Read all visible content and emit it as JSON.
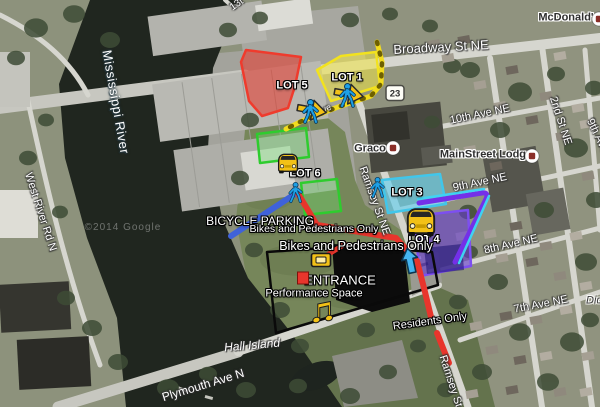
{
  "map": {
    "attribution": "©2014 Google",
    "highway_shield": {
      "label": "23",
      "x": 395,
      "y": 93
    },
    "labels": [
      {
        "id": "street-13t-partial",
        "text": "13t",
        "x": 237,
        "y": 5,
        "rot": -35,
        "style": "road",
        "size": 10
      },
      {
        "id": "broadway-st-ne",
        "text": "Broadway St NE",
        "x": 441,
        "y": 47,
        "rot": -3,
        "style": "road",
        "size": 13
      },
      {
        "id": "mcdonalds",
        "text": "McDonald's",
        "x": 569,
        "y": 18,
        "rot": 0,
        "style": "poi",
        "size": 11
      },
      {
        "id": "mississippi-river",
        "text": "Mississippi River",
        "x": 116,
        "y": 102,
        "rot": 80,
        "style": "water",
        "size": 13
      },
      {
        "id": "west-river-rd-n",
        "text": "West River Rd N",
        "x": 40,
        "y": 212,
        "rot": 72,
        "style": "road",
        "size": 11
      },
      {
        "id": "10th-ave-ne",
        "text": "10th Ave NE",
        "x": 480,
        "y": 115,
        "rot": -12,
        "style": "road",
        "size": 11
      },
      {
        "id": "2nd-st-ne",
        "text": "2nd St NE",
        "x": 560,
        "y": 121,
        "rot": 72,
        "style": "road",
        "size": 11
      },
      {
        "id": "9th-ave-right-edge",
        "text": "9th Ave",
        "x": 597,
        "y": 136,
        "rot": 64,
        "style": "road",
        "size": 11
      },
      {
        "id": "graco",
        "text": "Graco",
        "x": 370,
        "y": 149,
        "rot": 0,
        "style": "poi",
        "size": 11
      },
      {
        "id": "mainstreet-lodge",
        "text": "MainStreet Lodge",
        "x": 486,
        "y": 155,
        "rot": 0,
        "style": "poi",
        "size": 11
      },
      {
        "id": "9th-ave-ne",
        "text": "9th Ave NE",
        "x": 480,
        "y": 183,
        "rot": -12,
        "style": "road",
        "size": 11
      },
      {
        "id": "ramsey-st-ne",
        "text": "Ramsey St NE",
        "x": 374,
        "y": 201,
        "rot": 70,
        "style": "road",
        "size": 11
      },
      {
        "id": "8th-ave-ne",
        "text": "8th Ave NE",
        "x": 511,
        "y": 245,
        "rot": -13,
        "style": "road",
        "size": 11
      },
      {
        "id": "7th-ave-ne",
        "text": "7th Ave NE",
        "x": 541,
        "y": 305,
        "rot": -11,
        "style": "road",
        "size": 11
      },
      {
        "id": "dickens-partial",
        "text": "Dic",
        "x": 594,
        "y": 301,
        "rot": 0,
        "style": "area",
        "size": 11
      },
      {
        "id": "lot-5-label",
        "text": "LOT 5",
        "x": 292,
        "y": 86,
        "rot": 0,
        "style": "overlay-bold",
        "size": 11
      },
      {
        "id": "lot-1-label",
        "text": "LOT 1",
        "x": 347,
        "y": 78,
        "rot": 0,
        "style": "overlay-bold",
        "size": 11
      },
      {
        "id": "lot-6-label",
        "text": "LOT 6",
        "x": 305,
        "y": 174,
        "rot": 0,
        "style": "overlay-bold",
        "size": 11
      },
      {
        "id": "lot-3-label",
        "text": "LOT 3",
        "x": 407,
        "y": 193,
        "rot": 0,
        "style": "overlay-bold",
        "size": 11
      },
      {
        "id": "lot-4-label",
        "text": "LOT 4",
        "x": 424,
        "y": 240,
        "rot": 0,
        "style": "overlay-bold",
        "size": 11
      },
      {
        "id": "ave-partial",
        "text": "Ave",
        "x": 324,
        "y": 110,
        "rot": -25,
        "style": "road",
        "size": 9
      },
      {
        "id": "bicycle-parking",
        "text": "BICYCLE PARKING",
        "x": 260,
        "y": 221,
        "rot": 0,
        "style": "overlay",
        "size": 12
      },
      {
        "id": "bikes-pedestrians-1",
        "text": "Bikes and Pedestrians Only",
        "x": 314,
        "y": 229,
        "rot": 0,
        "style": "overlay",
        "size": 10.5
      },
      {
        "id": "bikes-pedestrians-2",
        "text": "Bikes and Pedestrians Only",
        "x": 356,
        "y": 246,
        "rot": 0,
        "style": "overlay",
        "size": 12.5
      },
      {
        "id": "entrance",
        "text": "ENTRANCE",
        "x": 340,
        "y": 280,
        "rot": 0,
        "style": "overlay",
        "size": 13
      },
      {
        "id": "performance-space",
        "text": "Performance Space",
        "x": 314,
        "y": 294,
        "rot": 0,
        "style": "overlay",
        "size": 11
      },
      {
        "id": "residents-only",
        "text": "Residents Only",
        "x": 430,
        "y": 322,
        "rot": -8,
        "style": "overlay",
        "size": 11
      },
      {
        "id": "hall-island",
        "text": "Hall Island",
        "x": 252,
        "y": 345,
        "rot": -5,
        "style": "island",
        "size": 12
      },
      {
        "id": "plymouth-ave-n",
        "text": "Plymouth Ave N",
        "x": 203,
        "y": 385,
        "rot": -17,
        "style": "road",
        "size": 12
      },
      {
        "id": "ramsey-st-ne-south",
        "text": "Ramsey St NE",
        "x": 453,
        "y": 390,
        "rot": 72,
        "style": "road",
        "size": 11
      },
      {
        "id": "google-watermark",
        "text": "©2014 Google",
        "x": 123,
        "y": 228,
        "rot": 0,
        "style": "watermark",
        "size": 10
      }
    ],
    "lots": [
      {
        "id": "lot-5-area",
        "fill": "rgba(232,52,40,0.55)",
        "stroke": "#ef3b2d",
        "points": "246,50 301,57 295,86 288,108 262,116 249,101 241,62"
      },
      {
        "id": "lot-1-area",
        "fill": "rgba(240,230,70,0.55)",
        "stroke": "#f2e21e",
        "points": "317,70 341,56 376,52 380,86 331,101"
      },
      {
        "id": "lot-6-area-north",
        "fill": "rgba(110,225,110,0.35)",
        "stroke": "#2ecc2e",
        "points": "257,134 306,128 309,157 260,163"
      },
      {
        "id": "lot-6-area-south",
        "fill": "rgba(110,225,110,0.35)",
        "stroke": "#2ecc2e",
        "points": "301,183 337,179 341,211 305,215"
      },
      {
        "id": "lot-3-area",
        "fill": "rgba(90,205,240,0.6)",
        "stroke": "#41c6ea",
        "points": "382,180 440,174 446,204 388,213"
      },
      {
        "id": "lot-4-area",
        "fill": "rgba(104,62,205,0.62)",
        "stroke": "#7d4ff0",
        "points": "414,216 468,210 471,266 420,276"
      },
      {
        "id": "lot-4-inner-area",
        "fill": "rgba(25,16,110,0.55)",
        "stroke": "none",
        "points": "424,248 462,244 464,270 427,274"
      },
      {
        "id": "performance-space-boundary",
        "fill": "none",
        "stroke": "#0a0a0a",
        "width": 2.5,
        "points": "267,252 352,246 432,252 438,285 276,333"
      }
    ],
    "paths": [
      {
        "id": "yellow-walking-route",
        "color": "#f2dc1e",
        "width": 5,
        "d": "M377,42 L382,62 L381,84 L371,96 L338,107 L302,121 L286,129"
      },
      {
        "id": "yellow-walking-route-ticks",
        "color": "#6e6000",
        "width": 4.5,
        "dash": "2 9",
        "d": "M377,42 L382,62 L381,84 L371,96 L338,107 L302,121 L286,129"
      },
      {
        "id": "bicycle-route",
        "color": "#3f62d9",
        "width": 6,
        "d": "M231,236 L298,192"
      },
      {
        "id": "red-pedestrian-route",
        "color": "#e8352c",
        "width": 6,
        "d": "M297,192 L317,225 L396,238 L417,261 L425,292 L431,317"
      },
      {
        "id": "red-residents-route",
        "color": "#e8352c",
        "width": 6,
        "d": "M437,333 L449,363"
      },
      {
        "id": "red-entrance-stub",
        "color": "#e8352c",
        "width": 5,
        "d": "M345,244 L324,257"
      },
      {
        "id": "purple-route",
        "color": "#7430e8",
        "width": 5,
        "d": "M419,203 L482,193 Q489,192 486,199 L455,262"
      },
      {
        "id": "cyan-route",
        "color": "#3fd2f2",
        "width": 2.5,
        "d": "M418,199 L484,189 M489,196 L459,263"
      }
    ],
    "icons": [
      {
        "type": "pedestrian-arrow",
        "id": "pedestrian-route-icon-1",
        "x": 348,
        "y": 96,
        "s": 1
      },
      {
        "type": "pedestrian-arrow",
        "id": "pedestrian-route-icon-2",
        "x": 311,
        "y": 112,
        "s": 1
      },
      {
        "type": "pedestrian",
        "id": "pedestrian-icon-bike-path",
        "x": 296,
        "y": 193,
        "s": 0.85
      },
      {
        "type": "pedestrian",
        "id": "pedestrian-icon-lot3",
        "x": 378,
        "y": 188,
        "s": 0.85
      },
      {
        "type": "car",
        "id": "car-icon-lot6",
        "x": 288,
        "y": 162,
        "s": 0.85
      },
      {
        "type": "car",
        "id": "car-icon-lot3",
        "x": 421,
        "y": 220,
        "s": 1.2
      },
      {
        "type": "arrow-up",
        "id": "lot4-arrow-icon",
        "x": 410,
        "y": 261,
        "s": 1
      },
      {
        "type": "music-note",
        "id": "performance-music-icon",
        "x": 320,
        "y": 310,
        "s": 1
      },
      {
        "type": "ticket",
        "id": "entrance-ticket-icon",
        "x": 321,
        "y": 260,
        "s": 1
      },
      {
        "type": "entrance-square",
        "id": "entrance-marker",
        "x": 303,
        "y": 278,
        "s": 1
      }
    ],
    "markers": [
      {
        "id": "graco-marker",
        "x": 393,
        "y": 148
      },
      {
        "id": "mainstreet-lodge-marker",
        "x": 532,
        "y": 156
      },
      {
        "id": "mcdonalds-marker",
        "x": 599,
        "y": 19
      }
    ]
  }
}
